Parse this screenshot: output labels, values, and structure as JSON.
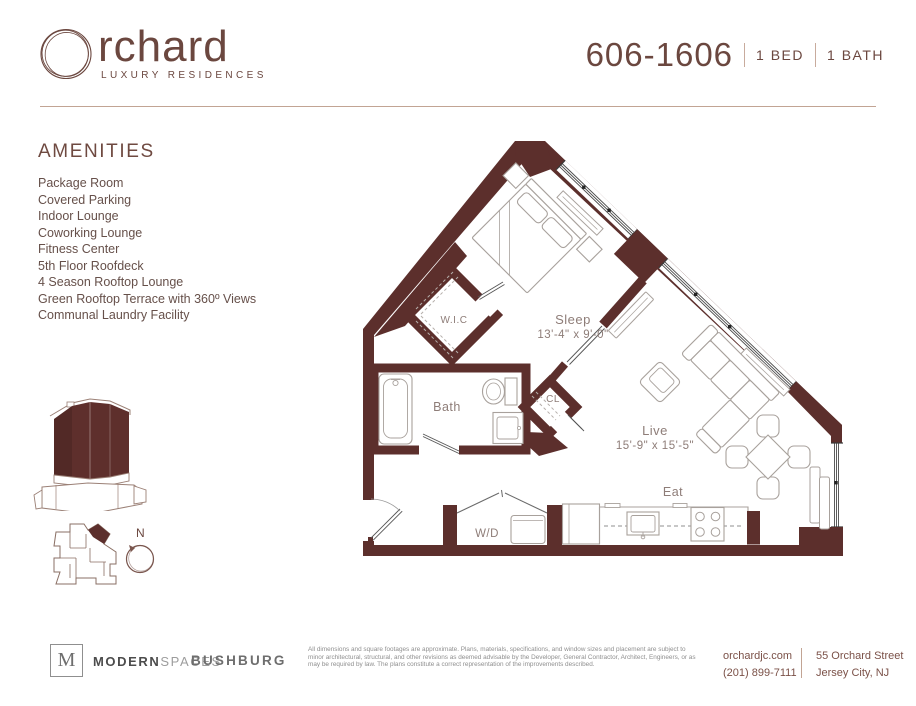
{
  "brand": {
    "logo_letter": "O",
    "logo_rest": "rchard",
    "tagline": "LUXURY RESIDENCES"
  },
  "unit": {
    "number": "606-1606",
    "bed_label": "1 BED",
    "bath_label": "1 BATH"
  },
  "amenities": {
    "title": "AMENITIES",
    "items": [
      "Package Room",
      "Covered Parking",
      "Indoor Lounge",
      "Coworking Lounge",
      "Fitness Center",
      "5th Floor Roofdeck",
      "4 Season Rooftop Lounge",
      "Green Rooftop Terrace with 360º Views",
      "Communal Laundry Facility"
    ]
  },
  "floorplan": {
    "compass": "N",
    "rooms": {
      "sleep": {
        "name": "Sleep",
        "dims": "13'-4\" x 9'-0\""
      },
      "live": {
        "name": "Live",
        "dims": "15'-9\" x 15'-5\""
      },
      "wic": "W.I.C",
      "bath": "Bath",
      "closet": "CL",
      "laundry": "W/D",
      "eat": "Eat"
    }
  },
  "footer": {
    "brokerage": {
      "initial": "M",
      "name_bold": "MODERN",
      "name_light": "SPACES"
    },
    "developer": "BUSHBURG",
    "disclaimer": "All dimensions and square footages are approximate. Plans, materials, specifications, and window sizes and placement are subject to minor architectural, structural, and other revisions as deemed advisable by the Developer, General Contractor, Architect, Engineers, or as may be required by law. The plans constitute a correct representation of the improvements described.",
    "website": "orchardjc.com",
    "phone": "(201) 899-7111",
    "address1": "55 Orchard Street",
    "address2": "Jersey City, NJ"
  },
  "colors": {
    "wall": "#5c2f2c",
    "brand": "#6b473f",
    "accent_line": "#c2a494"
  }
}
